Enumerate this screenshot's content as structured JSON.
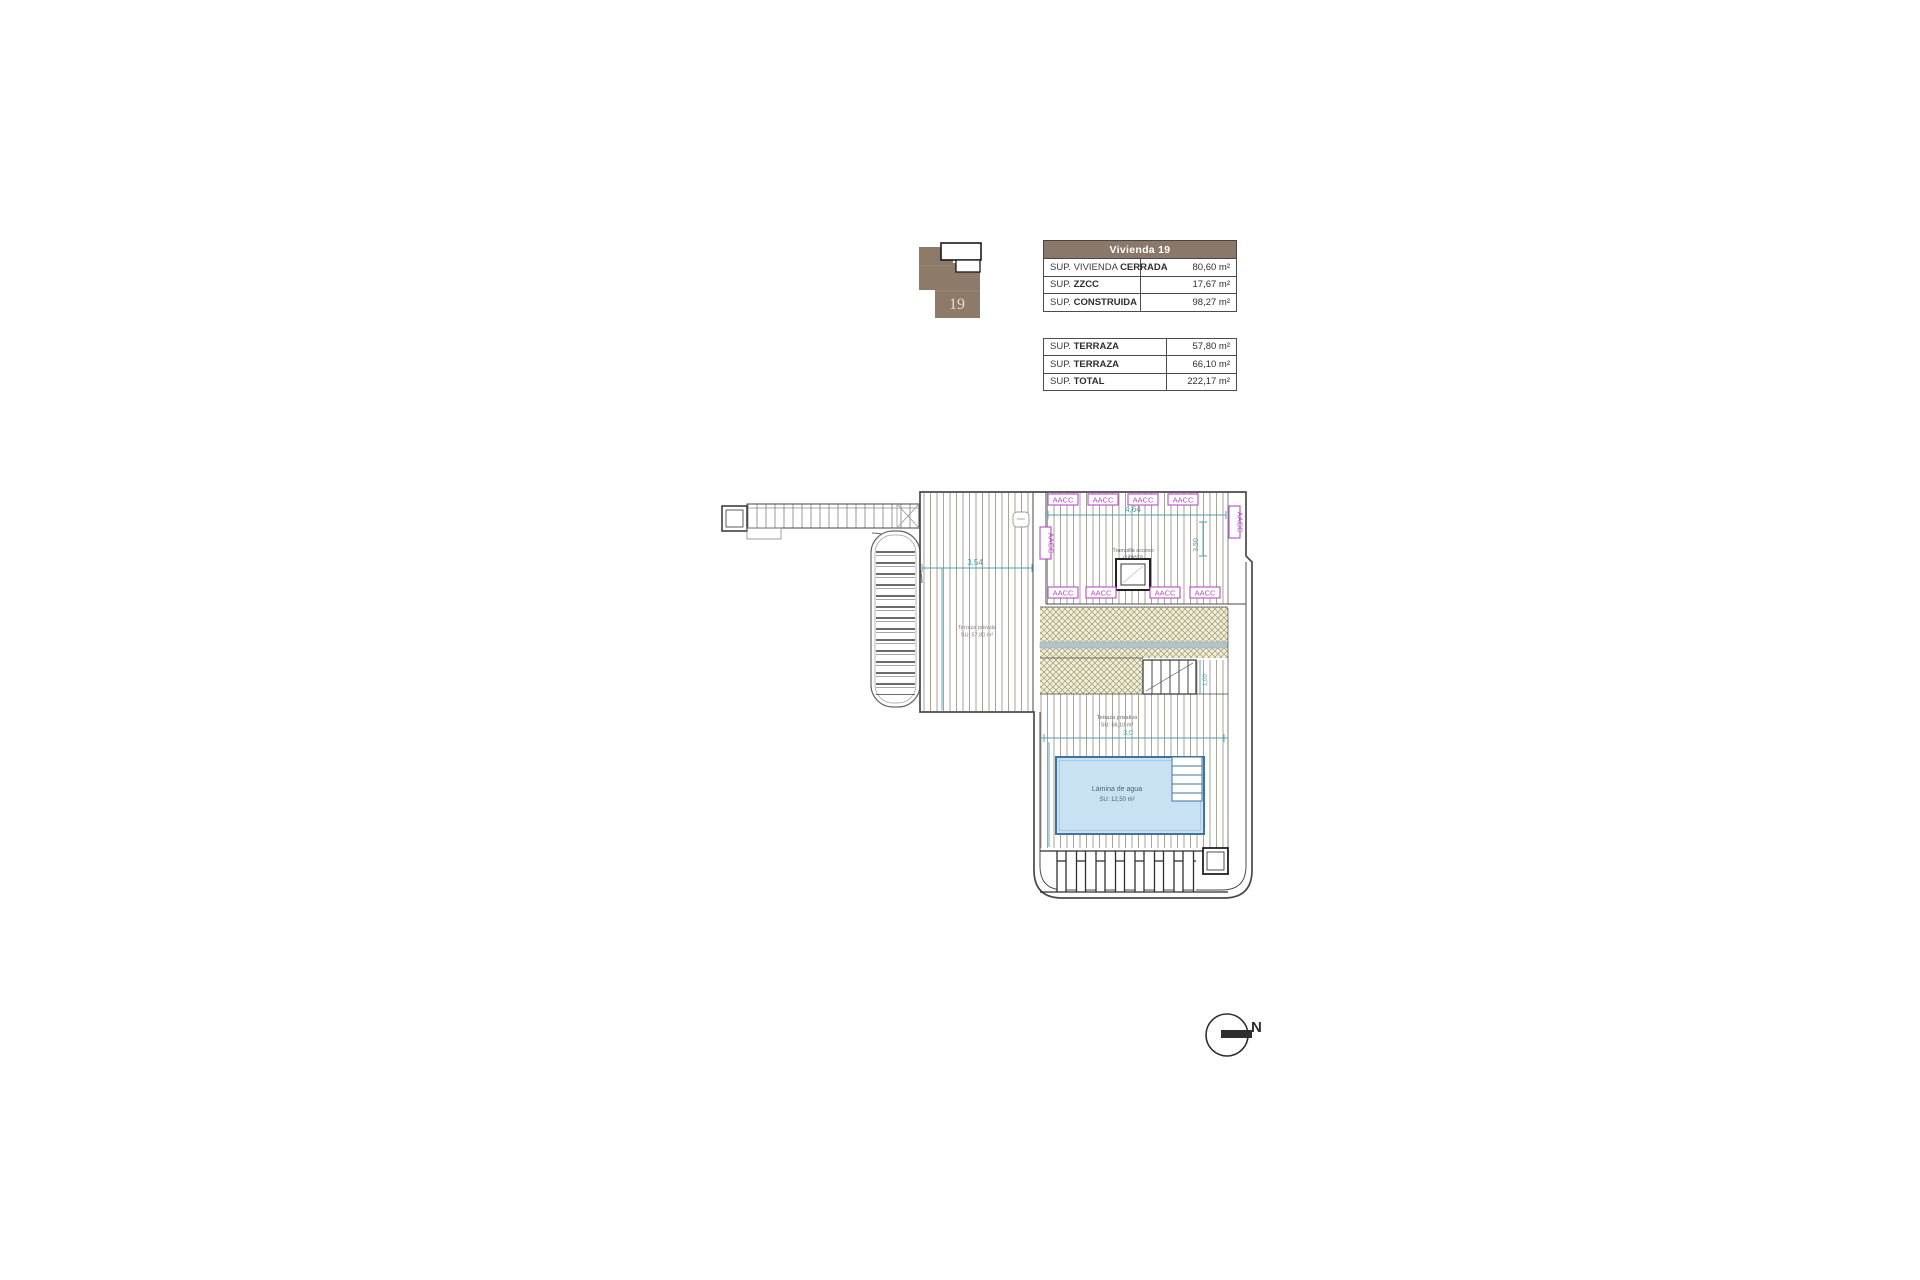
{
  "key_plan": {
    "unit_number": "19"
  },
  "area_table": {
    "header": "Vivienda 19",
    "rows": [
      {
        "prefix": "SUP. VIVIENDA ",
        "bold": "CERRADA",
        "value": "80,60 m²"
      },
      {
        "prefix": "SUP. ",
        "bold": "ZZCC",
        "value": "17,67 m²"
      },
      {
        "prefix": "SUP. ",
        "bold": "CONSTRUIDA",
        "value": "98,27 m²"
      }
    ]
  },
  "terrace_table": {
    "rows": [
      {
        "prefix": "SUP. ",
        "bold": "TERRAZA",
        "value": "57,80 m²"
      },
      {
        "prefix": "SUP. ",
        "bold": "TERRAZA",
        "value": "66,10 m²"
      },
      {
        "prefix": "SUP. ",
        "bold": "TOTAL",
        "value": "222,17 m²"
      }
    ]
  },
  "plan": {
    "aacc_label": "AACC",
    "trampilla_line1": "Trampilla acceso",
    "trampilla_line2": "cubierta",
    "terraza_upper_line1": "Terraza privada",
    "terraza_upper_line2": "SU: 57,80 m²",
    "terraza_lower_line1": "Terraza privativa",
    "terraza_lower_line2": "SU: 66,10 m²",
    "pool_line1": "Lámina de agua",
    "pool_line2": "SU: 12,50 m²",
    "dim_top": "4,64",
    "dim_right": "3,50",
    "dim_left_deck": "3,54",
    "dim_lower": "3,0",
    "dim_stairs": "1,00"
  },
  "compass": {
    "north_label": "N"
  },
  "colors": {
    "table_header_bg": "#8a796a",
    "key_plan_brown": "#8d7a69",
    "hatch_line": "#a2988b",
    "crosshatch_line": "#a29a6d",
    "crosshatch_bg": "#f0eeda",
    "gutter_band": "#b3c3ca",
    "aacc_magenta": "#b44fbe",
    "dimension_teal": "#4ba0ad",
    "pool_fill": "#c8e2f4",
    "pool_border": "#3f74a0",
    "outline": "#4a4a4a"
  }
}
